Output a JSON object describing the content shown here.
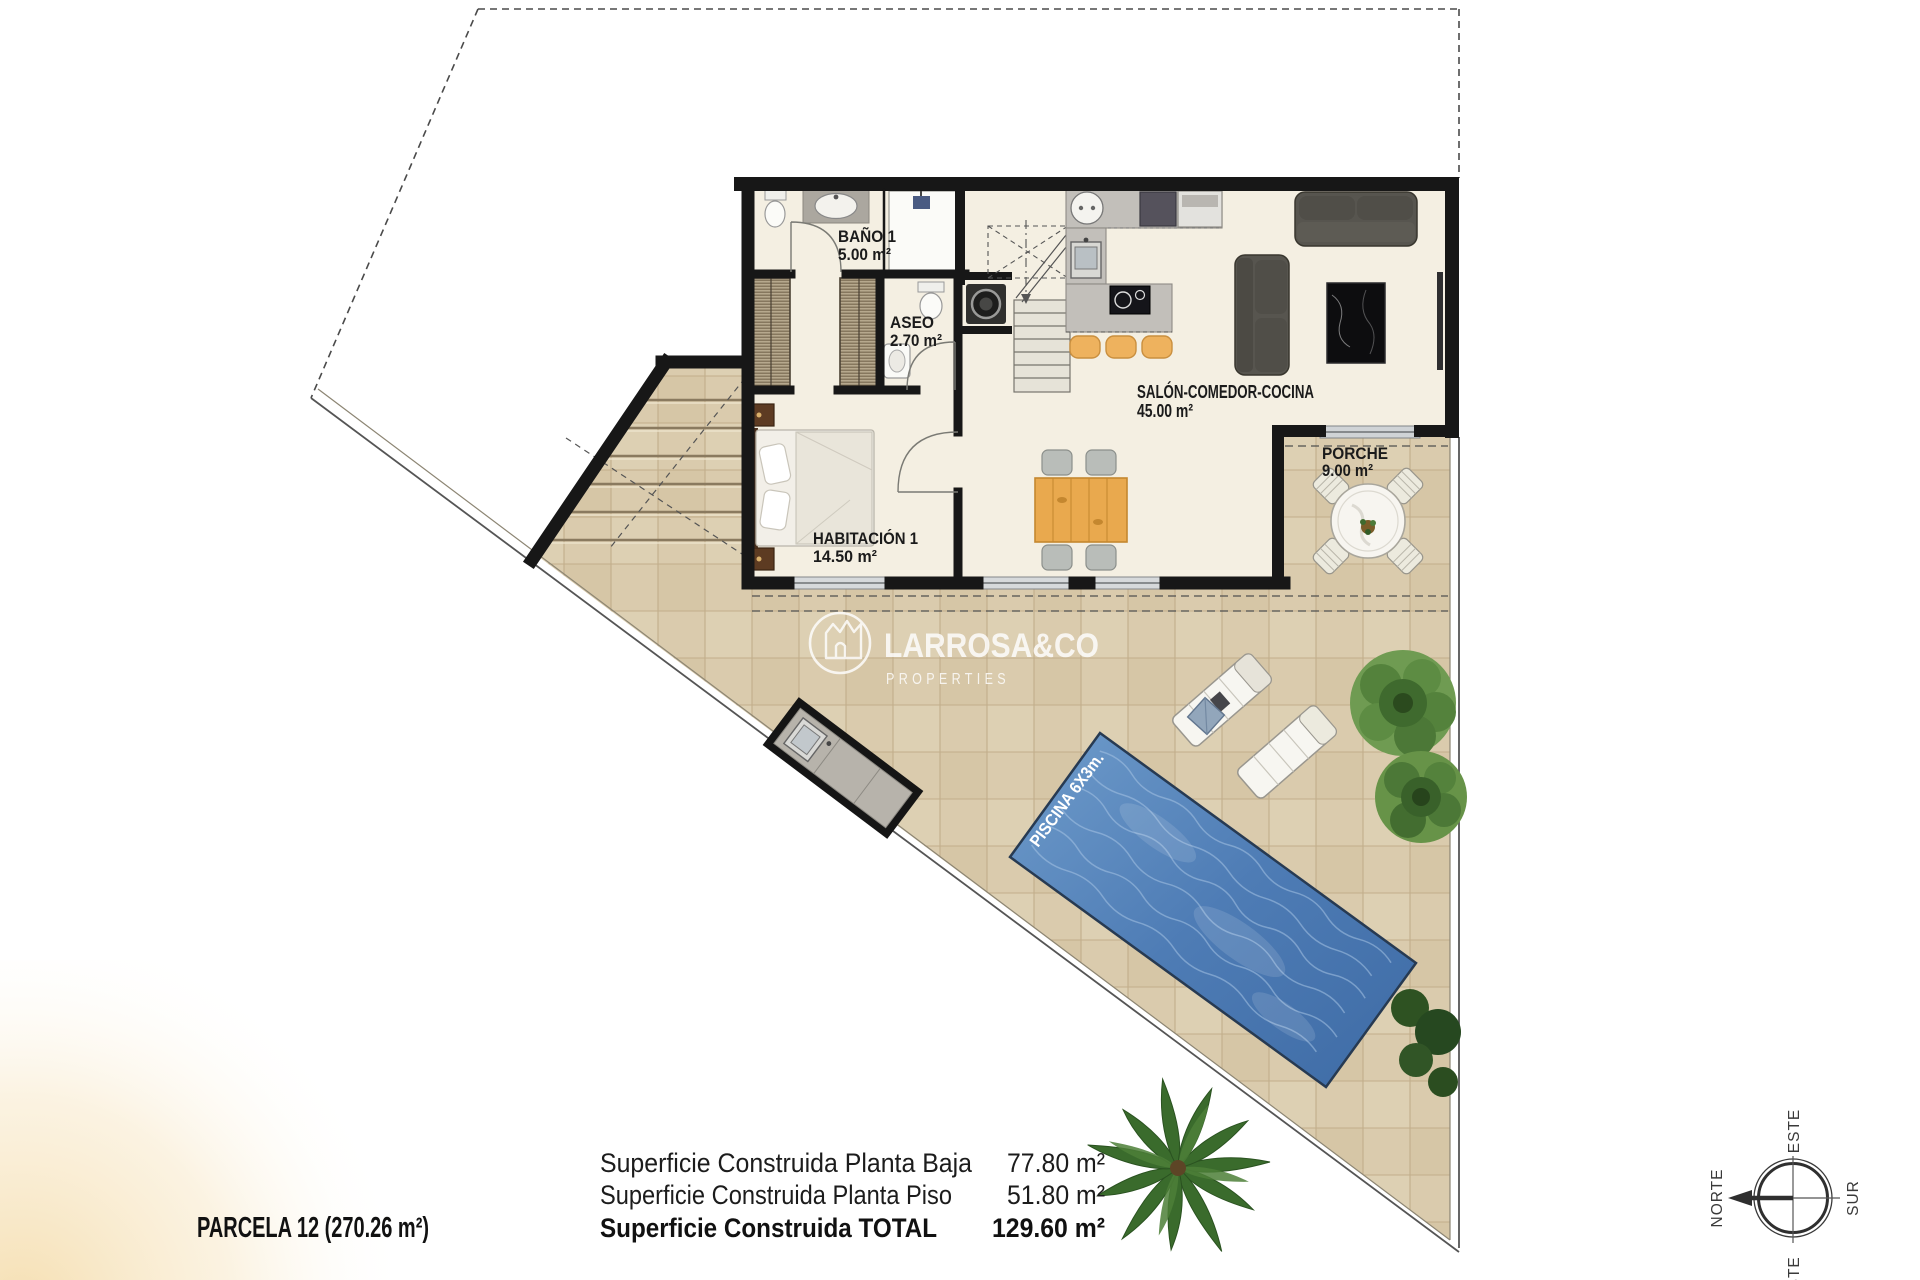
{
  "branding": {
    "name": "LARROSA&CO",
    "tagline": "PROPERTIES"
  },
  "rooms": {
    "bano": {
      "name": "BAÑO 1",
      "area": "5.00 m²"
    },
    "aseo": {
      "name": "ASEO",
      "area": "2.70 m²"
    },
    "habitacion": {
      "name": "HABITACIÓN 1",
      "area": "14.50 m²"
    },
    "salon": {
      "name": "SALÓN-COMEDOR-COCINA",
      "area": "45.00 m²"
    },
    "porche": {
      "name": "PORCHE",
      "area": "9.00 m²"
    }
  },
  "pool": {
    "label": "PISCINA 6X3m."
  },
  "summary": {
    "parcel": "PARCELA 12 (270.26 m²)",
    "rows": [
      {
        "label": "Superficie Construida Planta Baja",
        "value": "77.80 m²"
      },
      {
        "label": "Superficie Construida Planta Piso",
        "value": "51.80 m²"
      },
      {
        "label": "Superficie Construida TOTAL",
        "value": "129.60 m²"
      }
    ]
  },
  "compass": {
    "north": "NORTE",
    "east": "ESTE",
    "south": "SUR",
    "west": "OESTE"
  },
  "colors": {
    "wall": "#171717",
    "interior_floor": "#f4efe2",
    "terrace": "#dacbad",
    "pool_blue": "#4e7cb5",
    "wood": "#e9a94e",
    "vegetation": "#4e7d38",
    "label_text": "#1b1b1b",
    "watermark": "#ffffff"
  }
}
